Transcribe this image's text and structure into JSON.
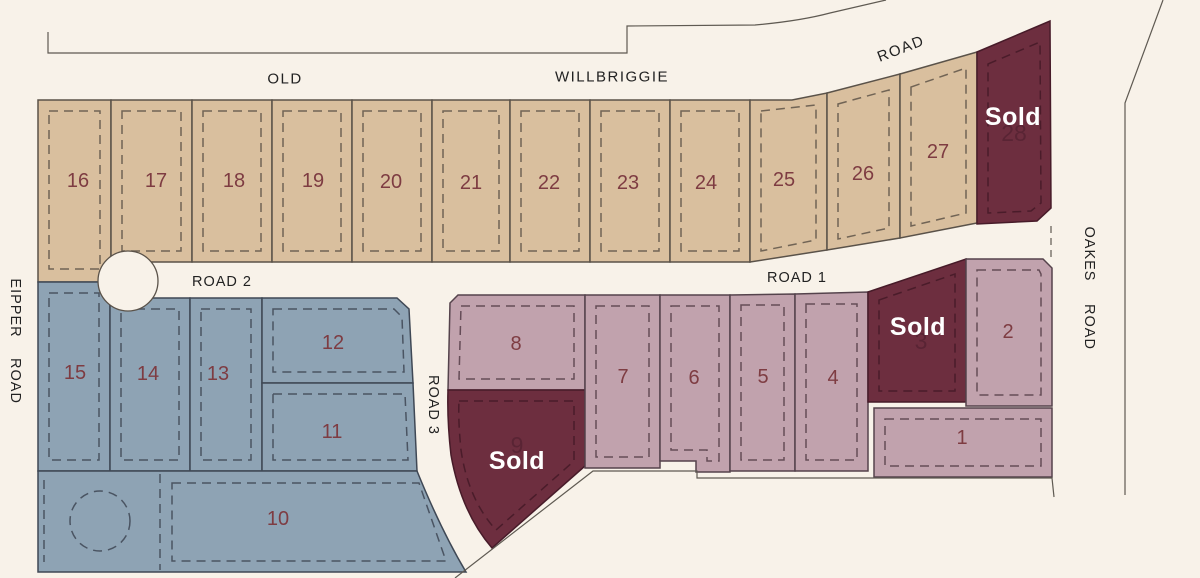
{
  "sold_label": "Sold",
  "roads": {
    "old": "OLD",
    "willbriggie": "WILLBRIGGIE",
    "road_top": "ROAD",
    "oakes_1": "OAKES",
    "oakes_2": "ROAD",
    "eipper_1": "EIPPER",
    "eipper_2": "ROAD",
    "road1": "ROAD 1",
    "road2": "ROAD 2",
    "road3": "ROAD 3"
  },
  "colors": {
    "background": "#f8f2e9",
    "tan_lot": "#d9bf9e",
    "blue_lot": "#8ea3b4",
    "mauve_lot": "#c1a2ad",
    "sold_lot": "#6d2e3f",
    "lot_number_text": "#7e3c42",
    "sold_text": "#ffffff",
    "road_label_text": "#222222"
  },
  "lots": [
    {
      "id": 1,
      "label": "1",
      "group": "mauve",
      "status": "available"
    },
    {
      "id": 2,
      "label": "2",
      "group": "mauve",
      "status": "available"
    },
    {
      "id": 3,
      "label": "3",
      "group": "mauve",
      "status": "sold"
    },
    {
      "id": 4,
      "label": "4",
      "group": "mauve",
      "status": "available"
    },
    {
      "id": 5,
      "label": "5",
      "group": "mauve",
      "status": "available"
    },
    {
      "id": 6,
      "label": "6",
      "group": "mauve",
      "status": "available"
    },
    {
      "id": 7,
      "label": "7",
      "group": "mauve",
      "status": "available"
    },
    {
      "id": 8,
      "label": "8",
      "group": "mauve",
      "status": "available"
    },
    {
      "id": 9,
      "label": "9",
      "group": "mauve",
      "status": "sold"
    },
    {
      "id": 10,
      "label": "10",
      "group": "blue",
      "status": "available"
    },
    {
      "id": 11,
      "label": "11",
      "group": "blue",
      "status": "available"
    },
    {
      "id": 12,
      "label": "12",
      "group": "blue",
      "status": "available"
    },
    {
      "id": 13,
      "label": "13",
      "group": "blue",
      "status": "available"
    },
    {
      "id": 14,
      "label": "14",
      "group": "blue",
      "status": "available"
    },
    {
      "id": 15,
      "label": "15",
      "group": "blue",
      "status": "available"
    },
    {
      "id": 16,
      "label": "16",
      "group": "tan",
      "status": "available"
    },
    {
      "id": 17,
      "label": "17",
      "group": "tan",
      "status": "available"
    },
    {
      "id": 18,
      "label": "18",
      "group": "tan",
      "status": "available"
    },
    {
      "id": 19,
      "label": "19",
      "group": "tan",
      "status": "available"
    },
    {
      "id": 20,
      "label": "20",
      "group": "tan",
      "status": "available"
    },
    {
      "id": 21,
      "label": "21",
      "group": "tan",
      "status": "available"
    },
    {
      "id": 22,
      "label": "22",
      "group": "tan",
      "status": "available"
    },
    {
      "id": 23,
      "label": "23",
      "group": "tan",
      "status": "available"
    },
    {
      "id": 24,
      "label": "24",
      "group": "tan",
      "status": "available"
    },
    {
      "id": 25,
      "label": "25",
      "group": "tan",
      "status": "available"
    },
    {
      "id": 26,
      "label": "26",
      "group": "tan",
      "status": "available"
    },
    {
      "id": 27,
      "label": "27",
      "group": "tan",
      "status": "available"
    },
    {
      "id": 28,
      "label": "28",
      "group": "tan",
      "status": "sold"
    }
  ]
}
